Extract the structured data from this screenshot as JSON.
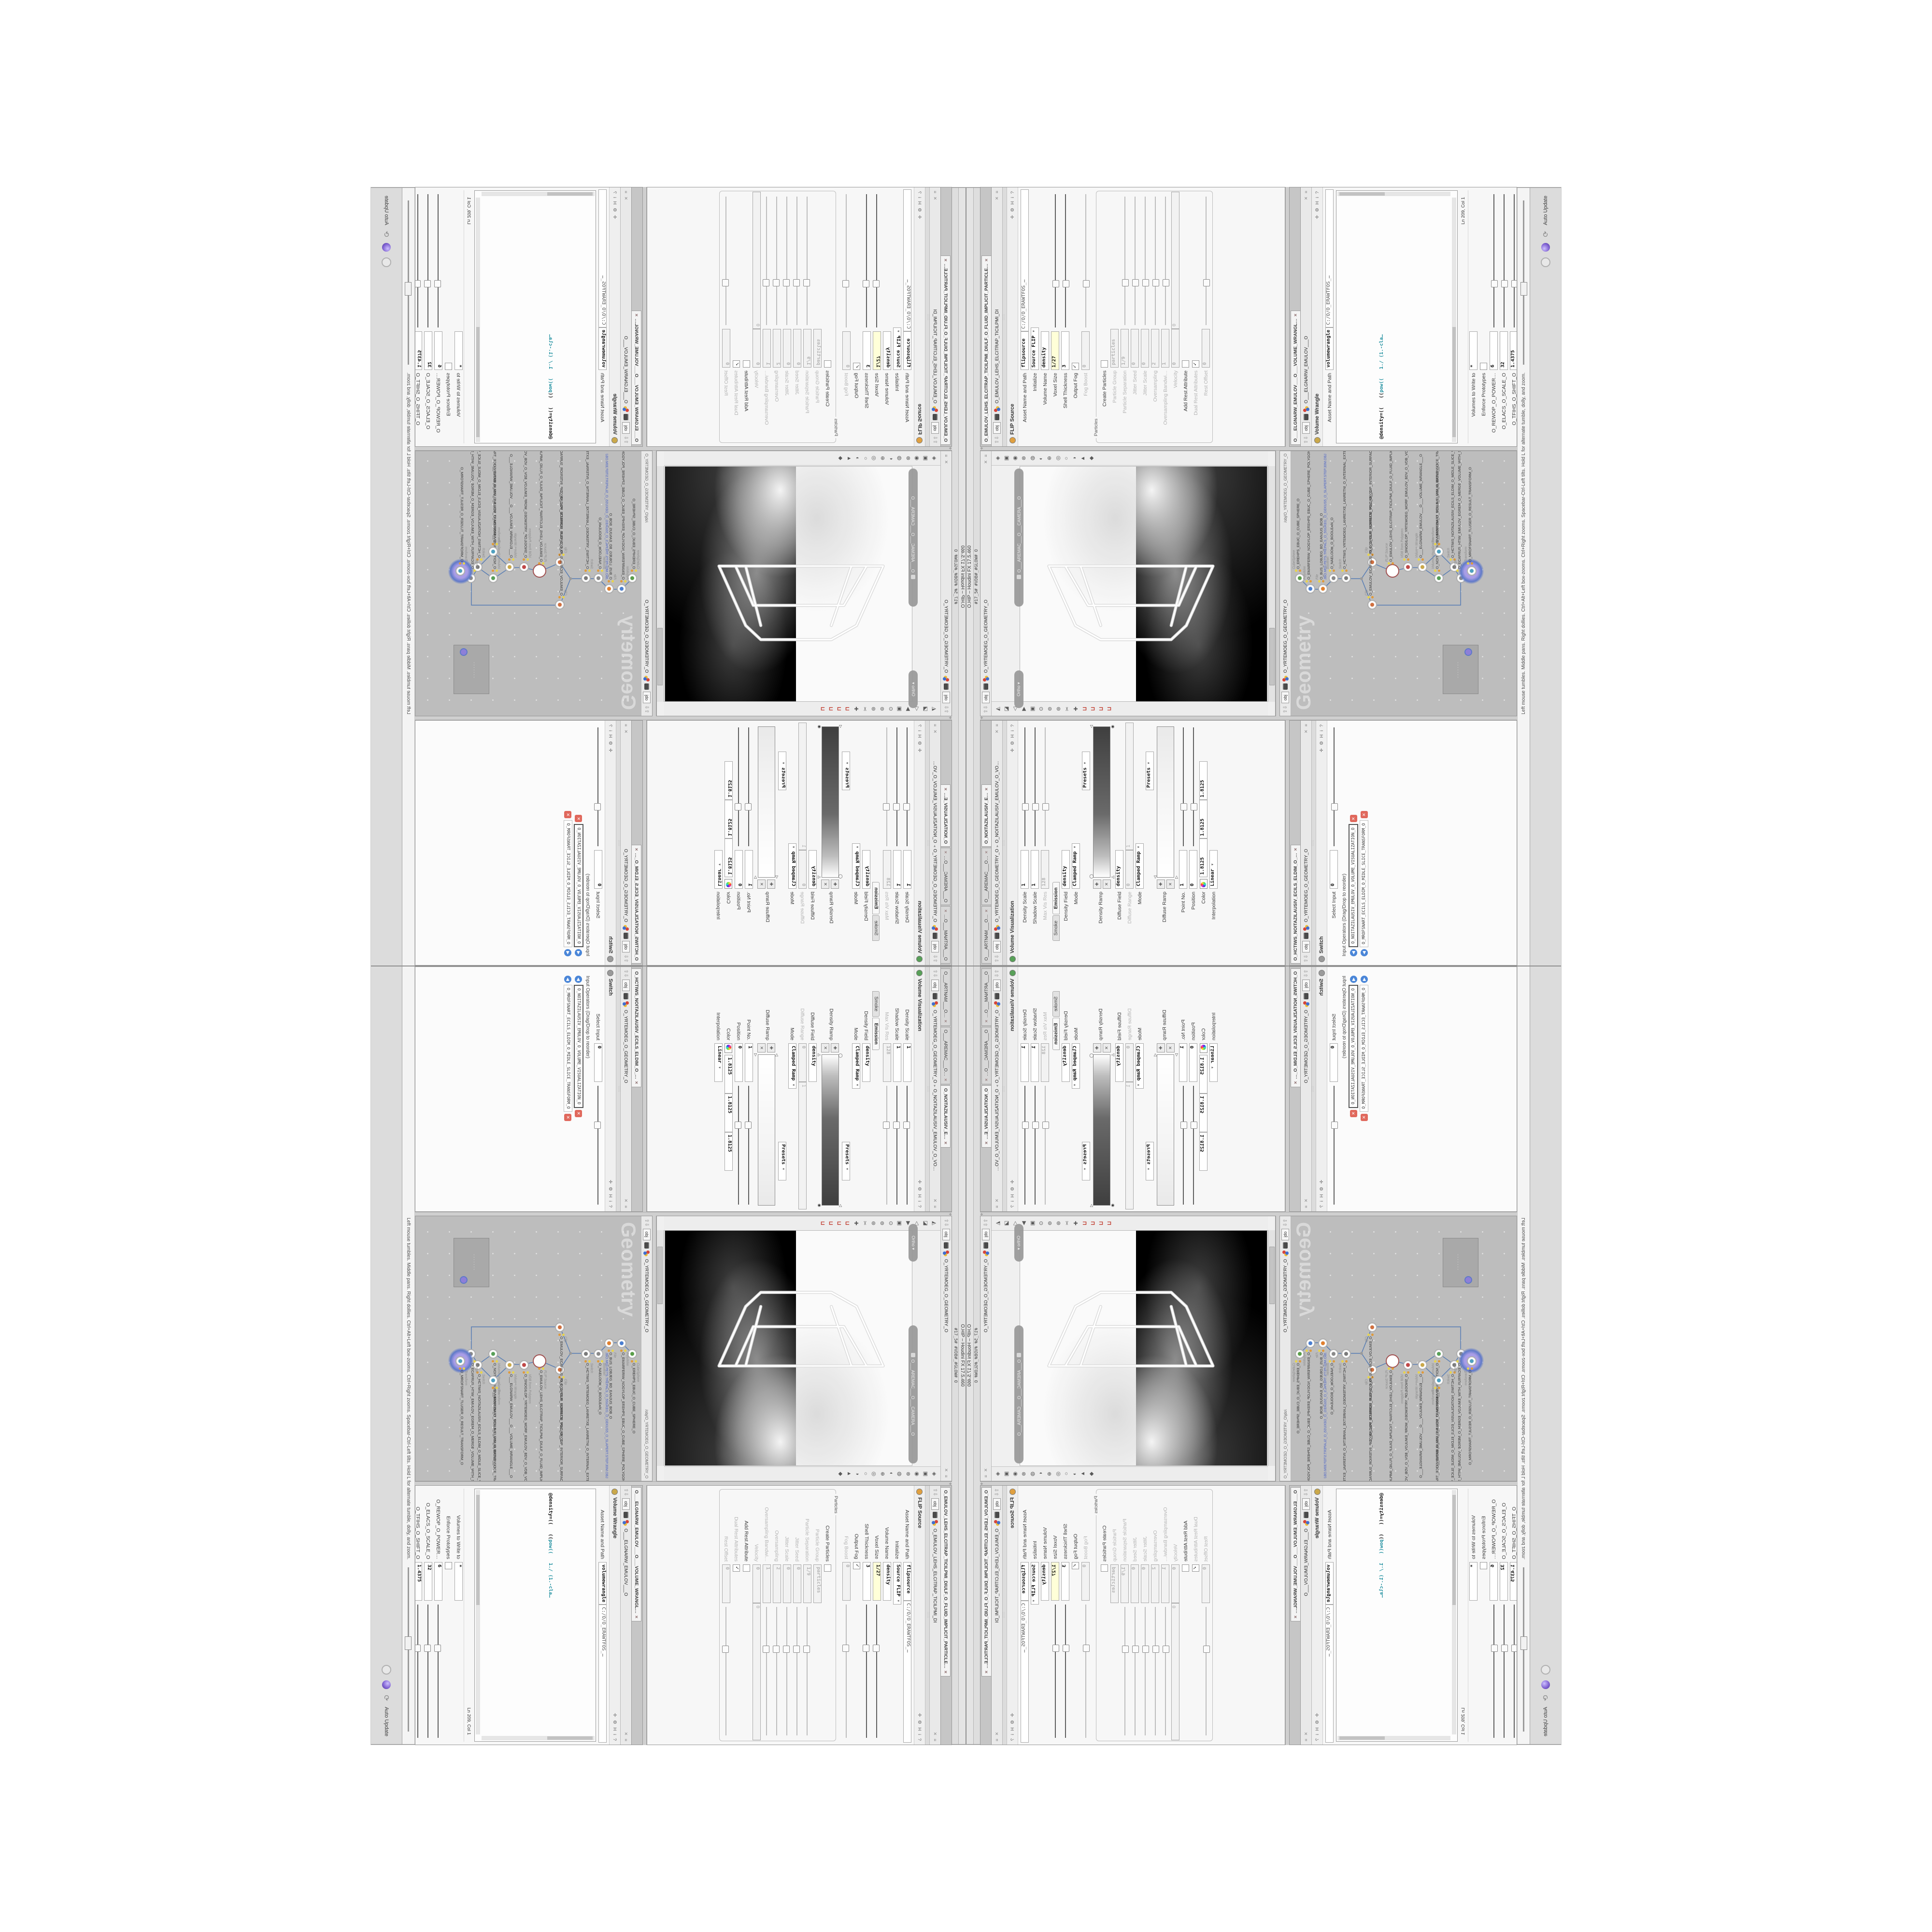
{
  "window": {
    "title": "O.HIP – Houdini FX 17.5.460",
    "menu_line": "#17_5#    #VDB#_#GLOW#    O",
    "hint": "Left mouse tumbles. Middle pans. Right dollies. Ctrl+Alt+Left box-zooms. Ctrl+Right zooms. Spacebar-Ctrl-Left tilts. Hold L for alternate tumble, dolly, and zoom.",
    "auto_update": "Auto Update"
  },
  "ui": {
    "header_icons": "✛ ⚙ H i ?",
    "breadcrumb_tab": "obj",
    "pane_close": "✕",
    "pane_more": "≡",
    "up_down": "⇧⇩",
    "grip": ":::::"
  },
  "colors": {
    "accent_yellow_field": "#ffffd8",
    "node_select_purple": "#8d7fd8",
    "wire_blue": "#5b7fb4",
    "comment_olive": "#9c9c28",
    "keyword_teal": "#1f8f9f",
    "file_path_blue": "#4a62c8"
  },
  "panes": {
    "volviz": {
      "tabs": [
        {
          "label": "O___ARTNAM___O…"
        },
        {
          "label": "O___AREMAC___O…"
        },
        {
          "label": "O_NOITAZILAUSIV_E…",
          "cls": "sel"
        }
      ],
      "node": "O_YRTEMOEG_O_GEOMETRY_O",
      "node2": "O_NOITAZILAUSIV_EMULOV_O_VO…",
      "title": "Volume Visualization",
      "rows": [
        {
          "label": "Density Scale",
          "value": "1",
          "cls": "slider"
        },
        {
          "label": "Shadow Scale",
          "value": "1",
          "cls": "slider"
        },
        {
          "label": "Max Vis Res",
          "value": "128",
          "cls": "dis slider"
        }
      ],
      "subtabs": [
        "Smoke",
        "Emission"
      ],
      "rows2": [
        {
          "label": "Density Field",
          "value": "density"
        },
        {
          "label": "Mode",
          "value": "Clamped Ramp",
          "cls": "combo"
        },
        {
          "label": "",
          "value": "Presets",
          "cls": "combo presets"
        }
      ],
      "ramp1_label": "Density Ramp",
      "rows3": [
        {
          "label": "Diffuse Field",
          "value": "density"
        },
        {
          "label": "Diffuse Range",
          "value": "0",
          "value2": "1",
          "cls": "dis two"
        },
        {
          "label": "Mode",
          "value": "Clamped Ramp",
          "cls": "combo"
        },
        {
          "label": "",
          "value": "Presets",
          "cls": "combo presets"
        }
      ],
      "ramp2_label": "Diffuse Ramp",
      "rows4": [
        {
          "label": "Point No.",
          "value": "1",
          "cls": "slider"
        },
        {
          "label": "Position",
          "value": "0",
          "cls": "slider"
        }
      ],
      "color_label": "Color",
      "rgb": [
        "1.8125",
        "1.8125",
        "1.8125"
      ],
      "rows5": [
        {
          "label": "Interpolation",
          "value": "Linear",
          "cls": "combo"
        }
      ],
      "ramp_btn_add": "✚",
      "ramp_btn_del": "✕"
    },
    "switch": {
      "tabs": [
        {
          "label": "O_HCTIWS_NOITAZILAUSIV_ECILS_ELDIM_O_…",
          "cls": "sel"
        }
      ],
      "node": "O_YRTEMOEG_O_GEOMETRY_O",
      "title": "Switch",
      "rows": [
        {
          "label": "Select Input",
          "value": "0",
          "cls": "slider"
        }
      ],
      "list_label": "Input Operators (Drag/Drop to reorder)",
      "inputs": [
        {
          "name": "O_NOITAZILAUSIV_EMULOV_O_VOLUME_VISUALIZATION_O",
          "cls": "sel"
        },
        {
          "name": "O_MROFSNART_ECILS_ELDIM_O_MIDLE_SLICE_TRANSFORM_O"
        }
      ]
    },
    "viewport": {
      "tab": "obj",
      "node": "O_YRTEMOEG_O_GEOMETRY_O",
      "camera": "O___AREMAC___O___CAMERA___O",
      "ortho": "Ortho ▾",
      "toolbar_right": "◈▣◉⊗◍◐⊕◎○◑▲◆",
      "toolbar_left": "◭◪◁▶▣⊙⊚⊛✂✚",
      "magnets": "⊔⊔⊔⊔"
    },
    "network": {
      "tab": "obj",
      "node": "O_YRTEMOEG_O_GEOMETRY_O",
      "path": "/obj/O_YRTEMOEG_O_GEOMETRY_O",
      "watermark": "Geometry",
      "minimap_dots": "·······",
      "nodes": [
        {
          "type": "CubeSphere",
          "name": "O_EREHPS_EBUC_O_CUBE_SPHERE_O",
          "style": "left:285px;top:18px;--ic:#5a9e4a"
        },
        {
          "type": "PolyWire",
          "name": "O_EMARFERIW_NOGYLOP_EREHPS_EBUC_O_CUBE_SPHERE_POLYGON_WIREFRAME_O",
          "style": "left:263px;top:40px;--ic:#4a7ed0"
        },
        {
          "type": "File",
          "name": "O_BUS_LOBJEG_BD_EANJUS_BOB_O",
          "path": "JBO.M03.PETS.TREPALS_O_5SUKEG_O_GEKUS5_O_SLAPERT.STEP.30M.OBJ",
          "style": "left:263px;top:66px;--ic:#e08030"
        },
        {
          "type": "Boolean",
          "name": "O_NAELOOB_O_BOOLEAN_O",
          "style": "left:285px;top:88px;--ic:#8a8a8a"
        },
        {
          "type": "Switch",
          "name": "O_HCTIWS_YRTEMOEG_LANRETXE_LANRETNI_O_INTERNAL_EXTERNAL_GEOMETRY_SWITCH_O",
          "style": "left:285px;top:114px;--ic:#7a7a7a"
        },
        {
          "type": "Clip",
          "name": "O_ECAFRUS_ROIRETNI_PILC_O_CLIP_INTERIOR_SURFACE_O",
          "style": "left:318px;top:168px;--ic:#d07040"
        },
        {
          "type": "Clip",
          "name": "O_EMULOV_ECAFRUS_PILC_O_CLIP_SURFACE_VOLUME_O",
          "style": "left:230px;top:168px;--ic:#d07040"
        },
        {
          "type": "FLIP Source",
          "name": "O_EMULOV_LEHS_ELCITRAP_TICILPMI_DIULF_O_FLUID_IMPLICIT_PARTICLE_SHEL_VOL…",
          "cls": "big",
          "style": "left:300px;top:210px"
        },
        {
          "type": "VDB from Polygons",
          "name": "O_SNOGILOP_YRTEMOEG_MORF_EMULOV_BDV_O_VDB_VOLUME_FROM_GEOMETRY_P…",
          "style": "left:308px;top:242px;--ic:#c04848"
        },
        {
          "type": "Volume Wrangle",
          "name": "O___ELGNARW_EMULOV___O___VOLUME_WRANGLE___O",
          "style": "left:308px;top:272px;--ic:#caa84a"
        },
        {
          "type": "Volume Visualization",
          "name": "O_NOITAZILAUSIV_EMULOV_O_VOLUME_VISUALIZATION_O",
          "style": "left:285px;top:306px;--ic:#58a058"
        },
        {
          "type": "Transform",
          "name": "O_MROFSNART_ECILS_ELDIM_O_MIDLE_SLICE_TRANSFORM_O",
          "style": "left:340px;top:306px;--ic:#50a0c0"
        },
        {
          "type": "Switch",
          "name": "O_HCTIWS_NOITAZILAUSIV_ECILS_ELDIM_O_MIDLE_SLICE_VISUALIZATION_SWITCH_O",
          "style": "left:308px;top:338px;--ic:#7a7a7a"
        },
        {
          "type": "Merge",
          "name": "O_ECAFRUS_HTIW_EMULOV_EGREM_O_MERGE_VOLUME_WITH_SURFACE_O",
          "style": "left:285px;top:352px;--ic:#8a8a8a"
        },
        {
          "type": "Transform",
          "name": "O_MROFSNART_TLUSER_O_RESULT_TRANSFORM_O",
          "cls": "selglow",
          "style": "left:300px;top:374px;--ic:#50a0c0"
        }
      ]
    },
    "flip": {
      "tabs": [
        {
          "label": "O_EMULOV_LEHS_ELCITRAP_TICILPMI_DIULF_O_FLUID_IMPLICIT_PARTICLE…",
          "cls": "sel"
        }
      ],
      "node": "O_EMULOV_LEHS_ELCITRAP_TICILPMI_DI",
      "title": "FLIP Source",
      "rows": [
        {
          "label": "Asset Name and Path",
          "value": "flipsource",
          "value2": "C:/O/O_ERAWTFOS_…",
          "cls": "two"
        },
        {
          "label": "Initialize",
          "value": "Source FLIP",
          "cls": "combo"
        },
        {
          "label": "Volume Name",
          "value": "density"
        },
        {
          "label": "Voxel Size",
          "value": "1/27",
          "cls": "hl slider"
        },
        {
          "label": "Shell Thickness",
          "value": "3",
          "cls": "slider"
        },
        {
          "label": "Output Fog",
          "cls": "check on"
        },
        {
          "label": "Fog Boost",
          "value": "0",
          "cls": "dis slider"
        }
      ],
      "group_label": "Particles",
      "particle_rows": [
        {
          "label": "Create Particles",
          "cls": "check"
        },
        {
          "label": "Particle Group",
          "value": "particles",
          "cls": "dis"
        },
        {
          "label": "Particle Separation",
          "value": "1/9",
          "cls": "dis slider"
        },
        {
          "label": "Jitter Seed",
          "value": "0",
          "cls": "dis slider"
        },
        {
          "label": "Jitter Scale",
          "value": "0",
          "cls": "dis slider"
        },
        {
          "label": "Oversampling",
          "value": "2",
          "cls": "dis slider"
        },
        {
          "label": "Oversampling Bandwi…",
          "value": "1",
          "cls": "dis slider"
        },
        {
          "label": "Velocity",
          "value": "0",
          "value2": "0",
          "cls": "dis two"
        },
        {
          "label": "Add Rest Attribute",
          "cls": "check"
        },
        {
          "label": "Dual Rest Attributes",
          "cls": "check on dis"
        },
        {
          "label": "Rest Offset",
          "value": "0",
          "cls": "dis slider"
        }
      ]
    },
    "wrangle": {
      "tabs": [
        {
          "label": "O___ELGNARW_EMULOV___O___VOLUME_WRANGL…",
          "cls": "sel"
        }
      ],
      "node": "O___ELGNARW_EMULOV___O",
      "title": "Volume Wrangle",
      "asset_row": {
        "label": "Asset Name and Path",
        "value": "volumewrangle",
        "value2": "C:/O/O_ERAWTFOS_…",
        "cls": "two"
      },
      "code1": [
        {
          "t": "//// ◎ 0D3%steserPym62%0D3%eziSym62%000.1D3%C62%000…"
        },
        {
          "t": "//// ◎ 0D3%steserPym62%0D3%eziSym62%000.1D3%C62%000…"
        },
        {
          "t": "//// ◎ \\\\\\\\"
        },
        {
          "t": "//// ◎ HTTP://MEMORYST◎MP.C◎M/graphtoy/#draw1%3Dtru…"
        },
        {
          "t": "//// ◎ HTTP://MEMORYST◎MP.C◎M/graphtoy/#draw1%3Dtru…"
        }
      ],
      "density_line": {
        "a": "@density=((   ((",
        "b": "pow",
        "c": "((   1./ (1.-cla…"
      },
      "code2": [
        {
          "t": "//// ◎ 0D3%steserPym62%0D3%eziSym62%000.1D3%C62%000…"
        },
        {
          "t": "//// ◎ 0D3%steserPym62%0D3%eziSym62%000.1D3%C62%000…"
        },
        {
          "t": "//// ◎ \\\\\\\\"
        },
        {
          "t": "//// ◎ HTTP://MEMORYST◎MP.C◎M/graphtoy/#draw1%3Dtru…"
        },
        {
          "t": "//// ◎ HTTP://MEMORYST◎MP.C◎M/graphtoy/#draw1%3Dtru…"
        }
      ],
      "cursor": "Ln 209, Col 1",
      "rows": [
        {
          "label": "Volumes to Write to",
          "value": "*"
        },
        {
          "label": "Enforce Prototypes",
          "cls": "check"
        },
        {
          "label": "O_REWOP_O_POWER…",
          "value": "6",
          "cls": "slider"
        },
        {
          "label": "O_ELACS_O_SCALE_O",
          "value": "32",
          "cls": "slider"
        },
        {
          "label": "O_TFIHS_O_SHIFT_O",
          "value": "1.4375",
          "cls": "slider bold"
        }
      ]
    }
  }
}
